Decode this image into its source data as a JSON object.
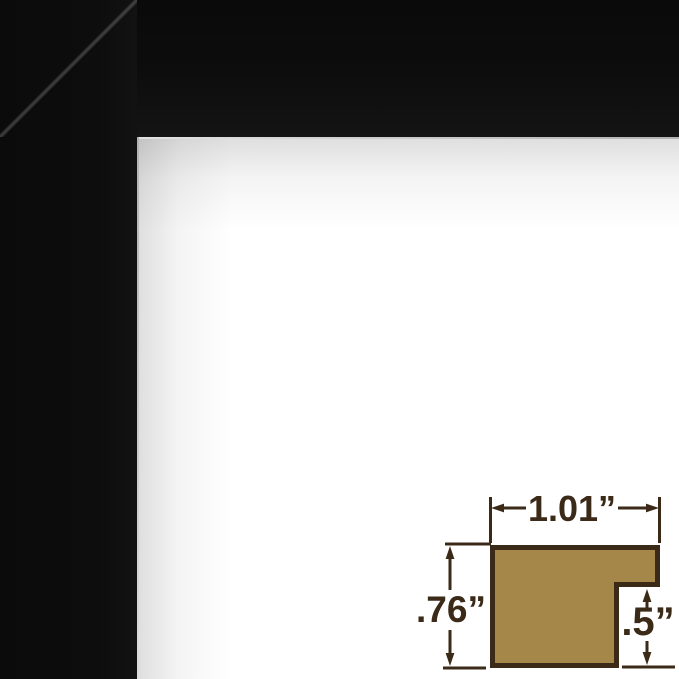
{
  "frame": {
    "color": "#0d0d0d",
    "edge_highlight_color": "#b3b3b3"
  },
  "diagram": {
    "width_label": "1.01”",
    "height_label": ".76”",
    "rabbet_label": ".5”",
    "profile_fill_color": "#a5874a",
    "line_color": "#3b2a18"
  }
}
